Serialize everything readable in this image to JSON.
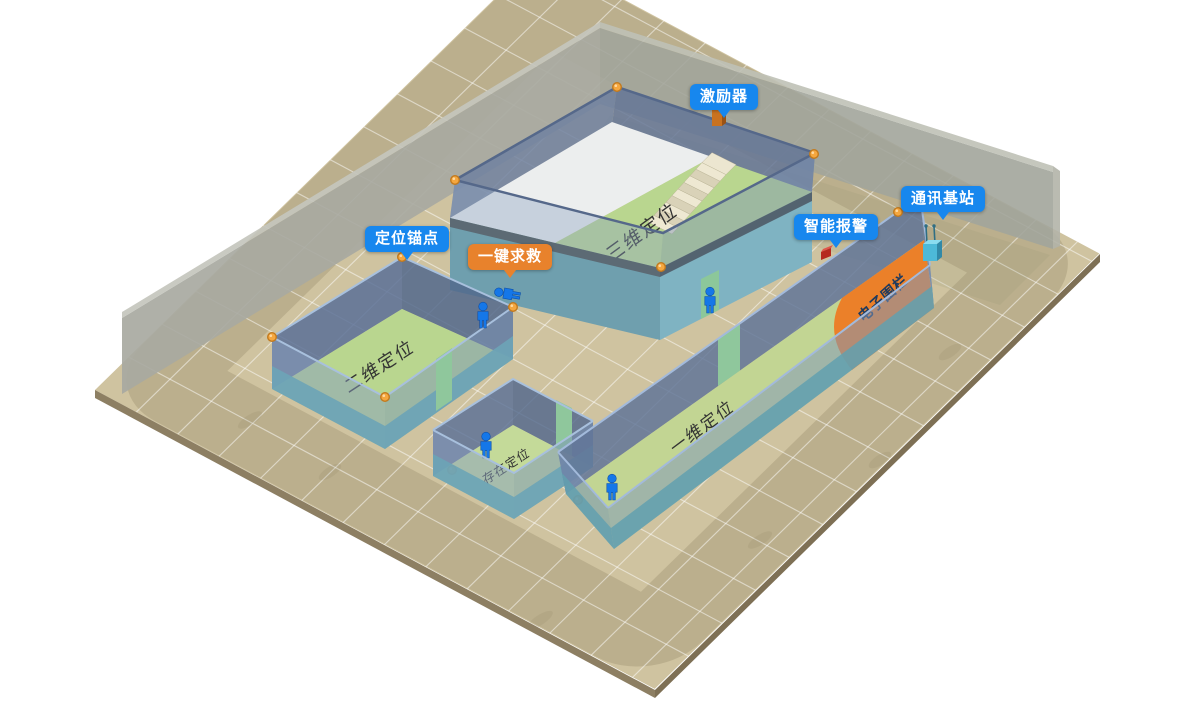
{
  "callouts": {
    "anchor": {
      "label": "定位锚点",
      "style": "blue"
    },
    "sos": {
      "label": "一键求救",
      "style": "orange"
    },
    "exciter": {
      "label": "激励器",
      "style": "blue"
    },
    "smart_alarm": {
      "label": "智能报警",
      "style": "blue"
    },
    "comm_base": {
      "label": "通讯基站",
      "style": "blue"
    }
  },
  "zones": {
    "three_d": {
      "label": "三维定位"
    },
    "two_d": {
      "label": "二维定位"
    },
    "one_d": {
      "label": "一维定位"
    },
    "presence": {
      "label": "存在定位"
    },
    "fence": {
      "label": "电子围栏"
    }
  },
  "colors": {
    "callout_blue": "#1787ee",
    "callout_orange": "#e8822c",
    "fence_orange": "#ec7d25",
    "floor_tan": "#cfc3a0",
    "zone_green": "#b9d68f",
    "wall_blue_translucent": "#7b95b8",
    "wall_teal": "#6ca4b6",
    "back_wall_gray": "#a8a9a1",
    "mezzanine_white": "#eceeee",
    "person_blue": "#1577e8",
    "anchor_orange": "#f5a73f",
    "fence_text": "#1d3a5f"
  }
}
